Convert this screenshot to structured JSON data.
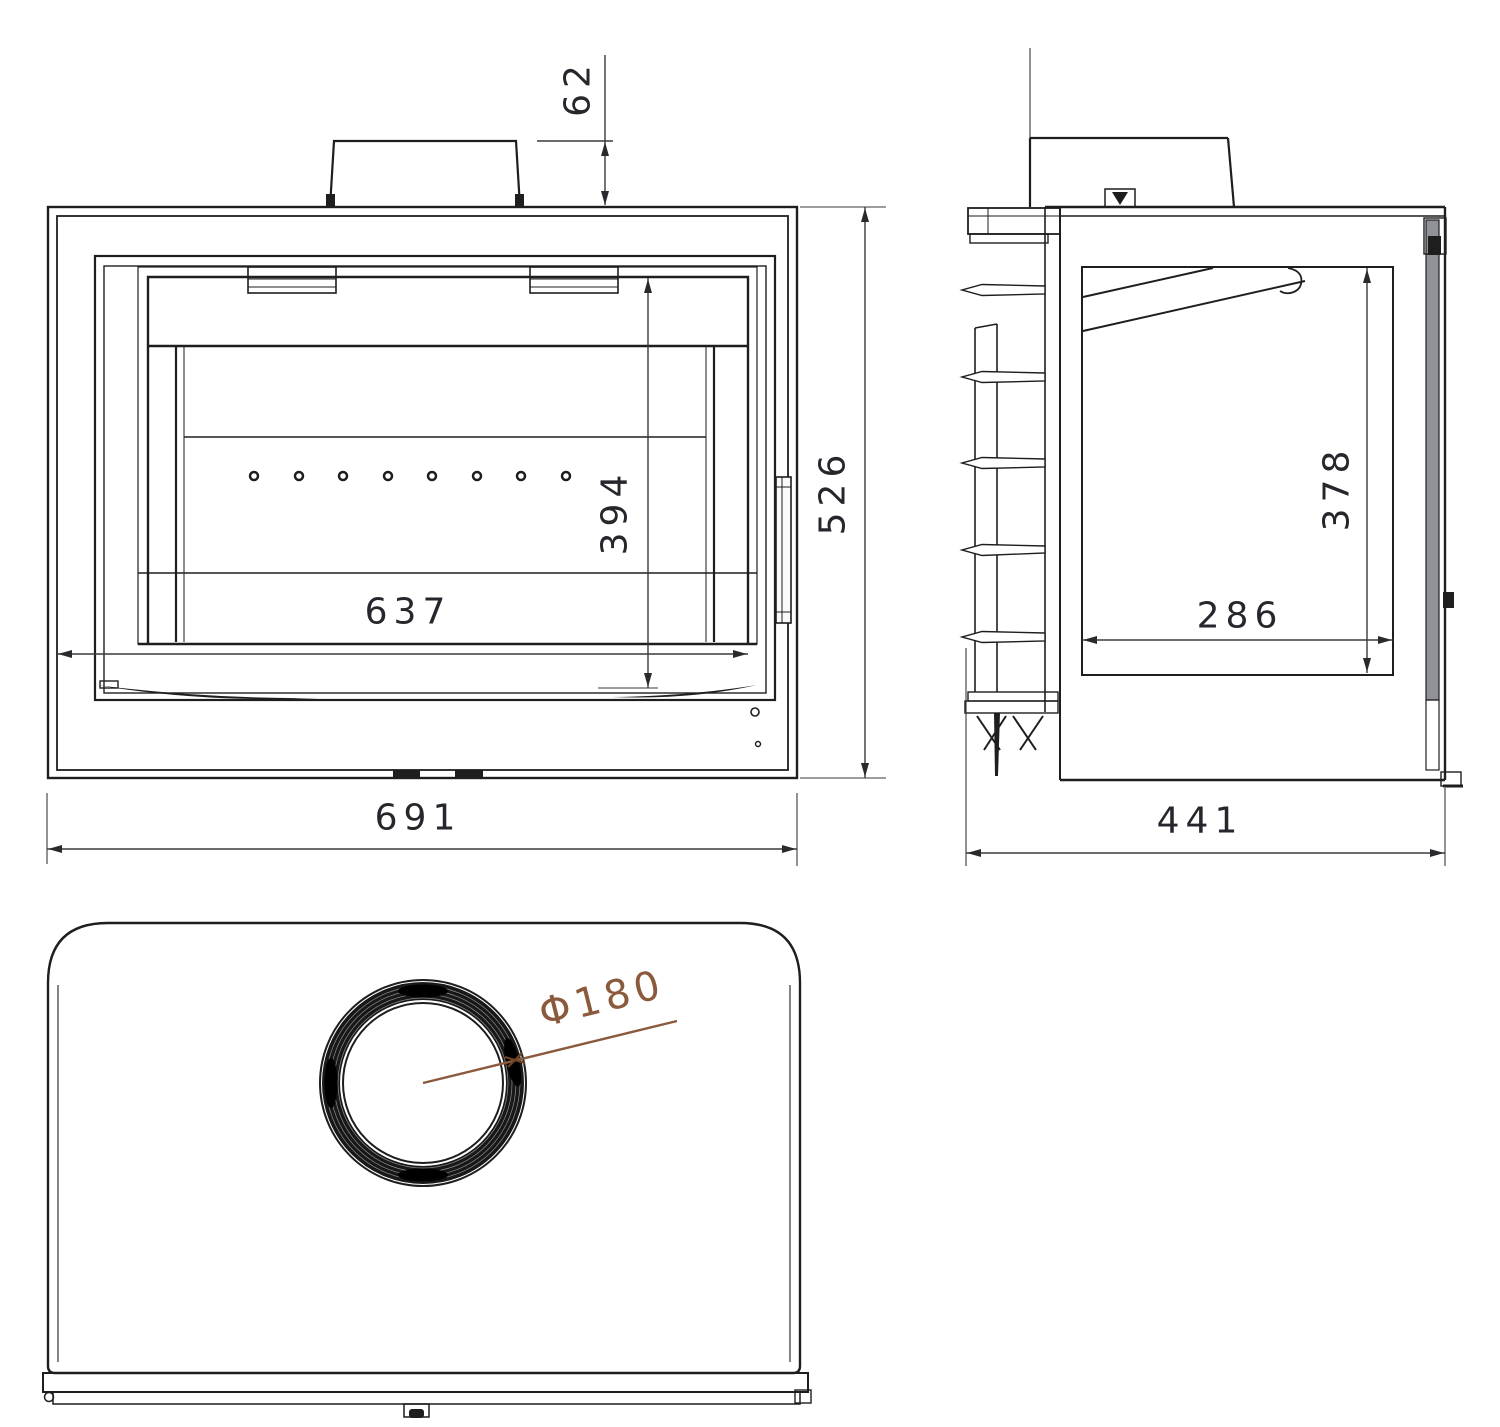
{
  "drawing": {
    "kind": "technical-drawing",
    "subject": "fireplace-insert-three-views",
    "dimensions": {
      "flue_height_offset": "62",
      "overall_height": "526",
      "overall_width": "691",
      "firebox_width": "637",
      "firebox_height": "394",
      "glass_height": "378",
      "firebox_depth": "286",
      "overall_depth": "441",
      "flue_diameter": "Φ180"
    },
    "colors": {
      "line": "#1e1e1e",
      "dim_line": "#3a3a3e",
      "dim_text": "#26262c",
      "accent": "#8b5a3c",
      "glass": "#8f9296",
      "background": "#ffffff"
    }
  }
}
